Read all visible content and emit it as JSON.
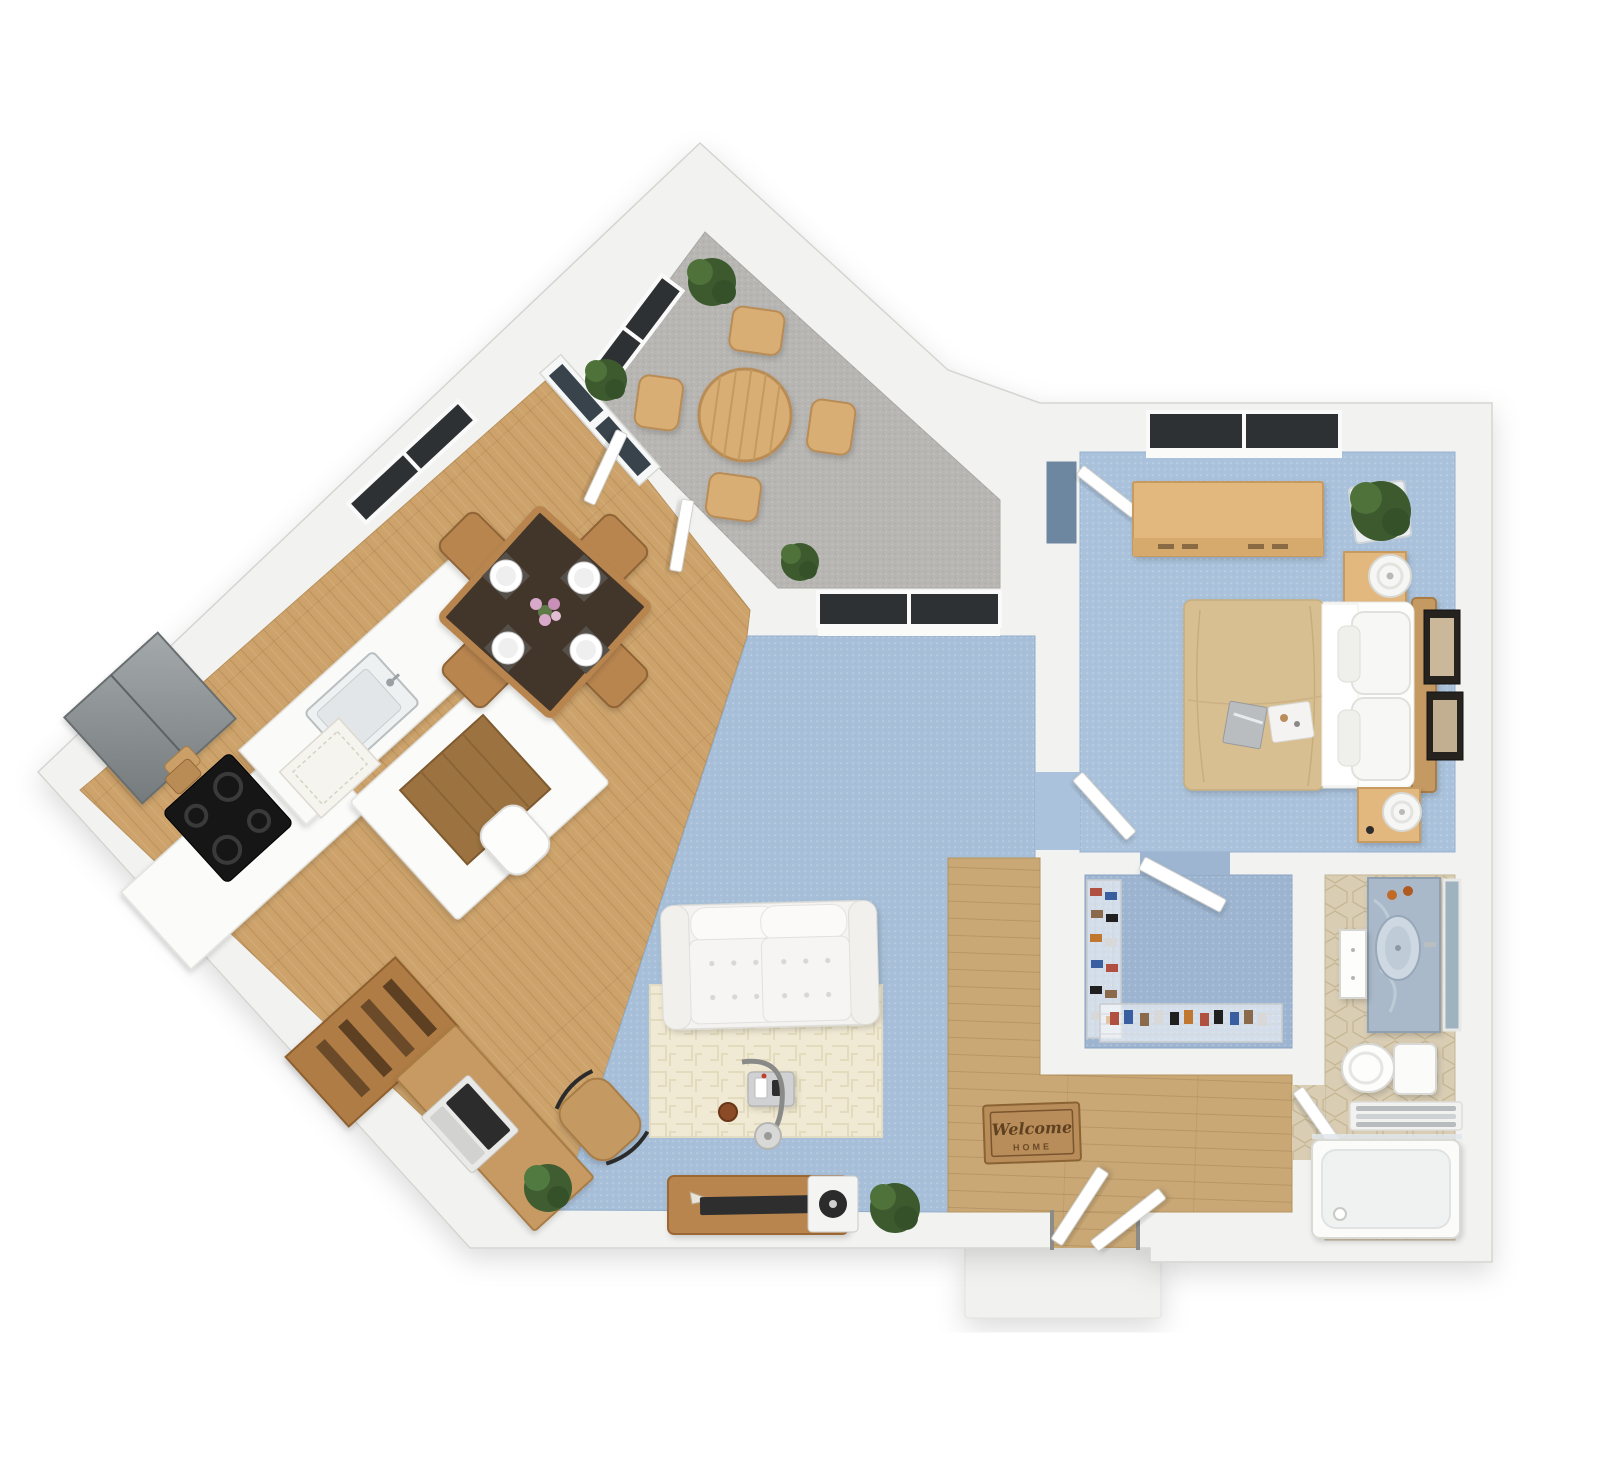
{
  "meta": {
    "title": "One-Bedroom Apartment 3D Floor Plan",
    "view": "top-down 3D render"
  },
  "colors": {
    "background": "#ffffff",
    "wall": "#f2f2f0",
    "wall_edge": "#d4d4d1",
    "wood_floor": "#cda36b",
    "wood_floor_hall": "#c9a876",
    "carpet_living": "#a7bfd8",
    "carpet_bedroom": "#aac2db",
    "carpet_closet": "#9db5d0",
    "patio_floor": "#b7b6b3",
    "tile_bath": "#d9cdb4",
    "rug_cream": "#f0e9d3",
    "sofa": "#f4f3f1",
    "duvet": "#d8bf92",
    "wood_furniture": "#e3b87e",
    "wood_dark": "#b9854f",
    "table_top": "#42362a",
    "plant": "#426032",
    "glass": "#2e3134",
    "marble": "#a9b9c9",
    "mat": "#b98d5a"
  },
  "rooms": [
    {
      "id": "patio",
      "label": "Patio",
      "floor": "gray carpet"
    },
    {
      "id": "kitchen-dining",
      "label": "Kitchen / Dining",
      "floor": "hardwood"
    },
    {
      "id": "living-room",
      "label": "Living Room",
      "floor": "blue carpet"
    },
    {
      "id": "entry-hall",
      "label": "Entry Hall",
      "floor": "hardwood"
    },
    {
      "id": "bedroom",
      "label": "Bedroom",
      "floor": "blue carpet"
    },
    {
      "id": "walk-in-closet",
      "label": "Walk-in Closet",
      "floor": "blue carpet"
    },
    {
      "id": "bathroom",
      "label": "Bathroom",
      "floor": "hex tile"
    }
  ],
  "furniture": {
    "patio": [
      "round dining table",
      "4 patio chairs",
      "3 potted plants"
    ],
    "kitchen": [
      "refrigerator",
      "range cooktop",
      "sink counter",
      "island breakfast nook",
      "stool",
      "runner rug",
      "cutting boards"
    ],
    "dining": [
      "square dining table",
      "4 chairs",
      "4 place settings",
      "flower centerpiece"
    ],
    "office": [
      "desk",
      "laptop",
      "office chair",
      "bookshelf",
      "potted plant"
    ],
    "living": [
      "loveseat sofa",
      "area rug",
      "arc floor lamp",
      "side table",
      "coffee cup",
      "tv console",
      "tv",
      "record player",
      "potted plant"
    ],
    "bedroom": [
      "double bed",
      "2 nightstands",
      "2 table lamps",
      "dresser",
      "potted plant",
      "2 wall frames",
      "magazine",
      "decor tray"
    ],
    "closet": [
      "wire shoe racks",
      "closet door"
    ],
    "bathroom": [
      "vanity with sink",
      "mirror",
      "storage cabinet",
      "toilet",
      "towel rack",
      "bathtub"
    ]
  },
  "entry_mat": {
    "line1": "Welcome",
    "line2": "HOME"
  }
}
